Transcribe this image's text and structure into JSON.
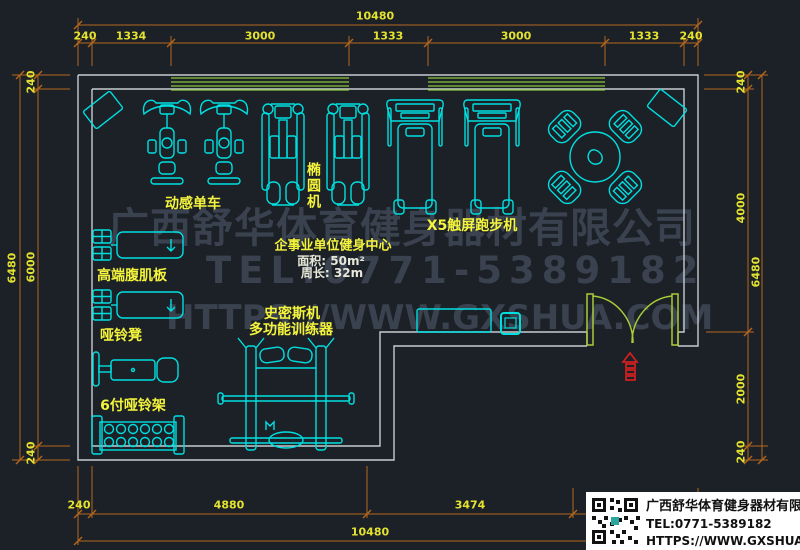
{
  "drawing": {
    "room_info": {
      "title": "企事业单位健身中心",
      "area": "面积: 50m²",
      "perimeter": "周长: 32m"
    },
    "equipment_labels": {
      "spin_bike": "动感单车",
      "elliptical": "椭圆机",
      "treadmill": "X5触屏跑步机",
      "ab_board": "高端腹肌板",
      "dumbbell_bench": "哑铃凳",
      "dumbbell_rack": "6付哑铃架",
      "smith_line1": "史密斯机",
      "smith_line2": "多功能训练器"
    }
  },
  "dims": {
    "top_overall": "10480",
    "top_segments": [
      "240",
      "1334",
      "3000",
      "1333",
      "3000",
      "1333",
      "240"
    ],
    "left_overall": "6480",
    "left_segments": [
      "240",
      "6000",
      "240"
    ],
    "right_overall": "6480",
    "right_segments": [
      "240",
      "4000",
      "2000",
      "240"
    ],
    "bottom_overall": "10480",
    "bottom_segments": [
      "240",
      "4880",
      "3474"
    ]
  },
  "watermark": {
    "line1": "广西舒华体育健身器材有限公司",
    "line2": "TEL:0771-5389182",
    "line3": "HTTPS://WWW.GXSHUA.COM"
  },
  "logo": {
    "company": "广西舒华体育健身器材有限公司",
    "tel": "TEL:0771-5389182",
    "url": "HTTPS://WWW.GXSHUA.COM"
  },
  "colors": {
    "background": "#1c2127",
    "wall": "#c7ccd1",
    "equipment": "#00dfe0",
    "label": "#f4f43c",
    "dimension_line": "#b4671c",
    "dimension_text": "#e3e32f",
    "window": "#8cc63f",
    "door": "#a8cc38",
    "exit_symbol": "#cc2020",
    "watermark": "#3a4250",
    "logo_bg": "#ffffff",
    "logo_text": "#111111"
  }
}
